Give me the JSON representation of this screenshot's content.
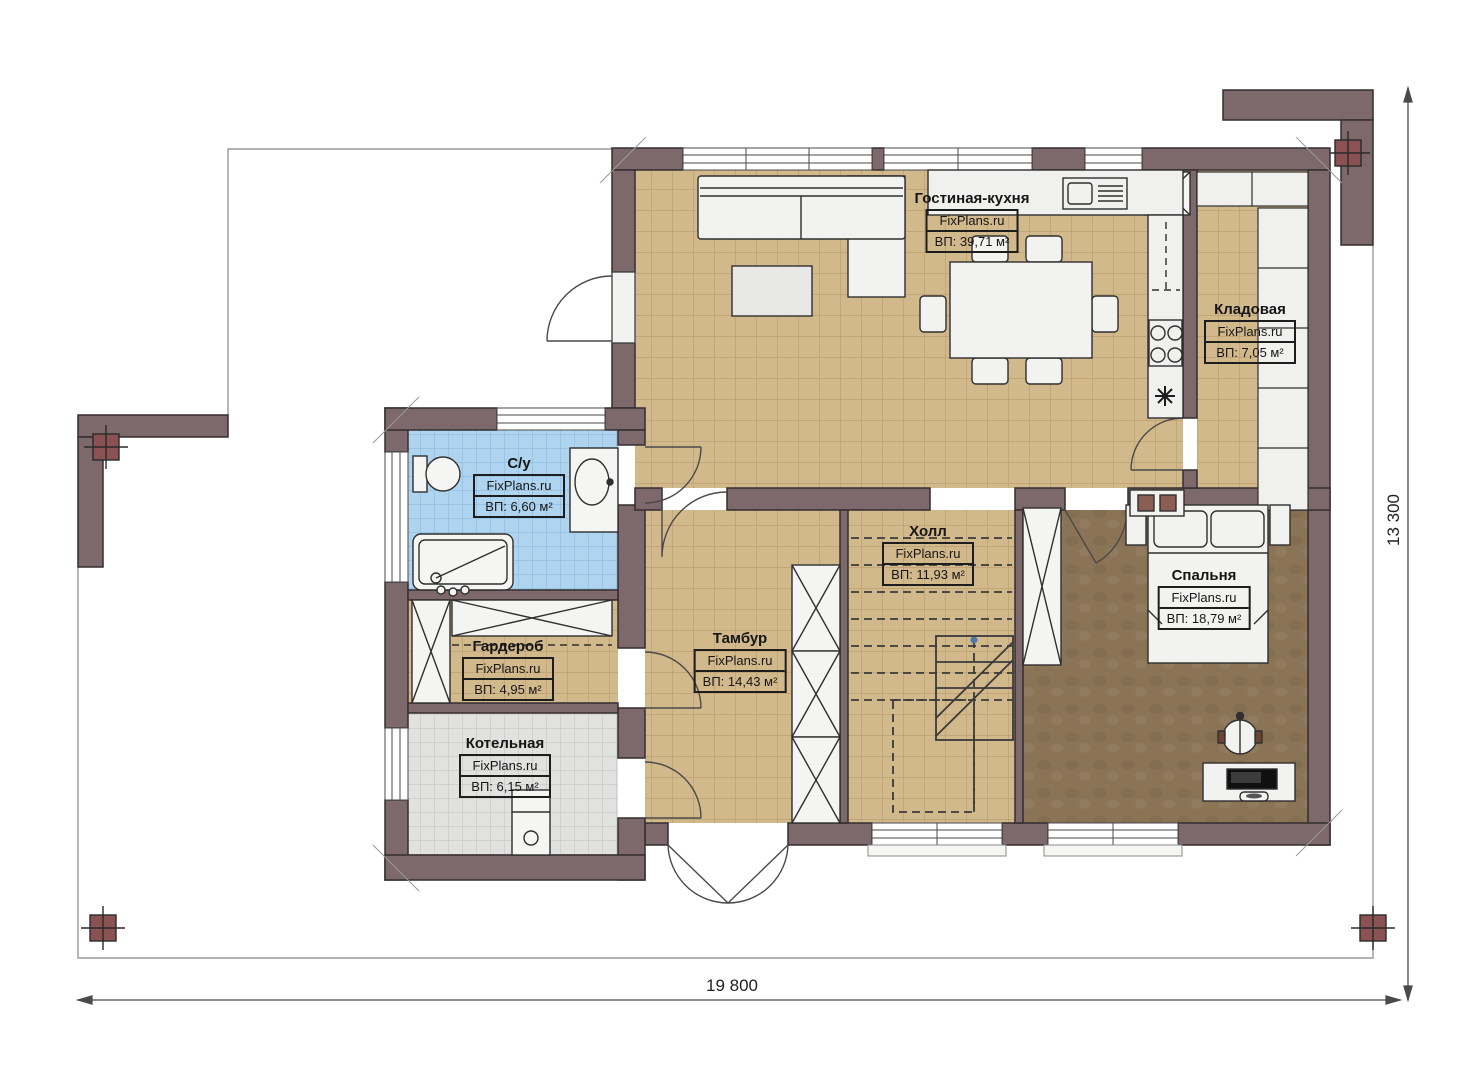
{
  "watermark": "FixPlans.ru",
  "dimensions": {
    "width_mm": "19 800",
    "height_mm": "13 300"
  },
  "rooms": [
    {
      "name": "Гостиная-кухня",
      "watermark": "FixPlans.ru",
      "area": "ВП: 39,71 м²"
    },
    {
      "name": "Кладовая",
      "watermark": "FixPlans.ru",
      "area": "ВП: 7,05 м²"
    },
    {
      "name": "С/у",
      "watermark": "FixPlans.ru",
      "area": "ВП: 6,60 м²"
    },
    {
      "name": "Холл",
      "watermark": "FixPlans.ru",
      "area": "ВП: 11,93 м²"
    },
    {
      "name": "Тамбур",
      "watermark": "FixPlans.ru",
      "area": "ВП: 14,43 м²"
    },
    {
      "name": "Гардероб",
      "watermark": "FixPlans.ru",
      "area": "ВП: 4,95 м²"
    },
    {
      "name": "Котельная",
      "watermark": "FixPlans.ru",
      "area": "ВП: 6,15 м²"
    },
    {
      "name": "Спальня",
      "watermark": "FixPlans.ru",
      "area": "ВП: 18,79 м²"
    }
  ],
  "colors": {
    "wall": "#7d686b",
    "floor_tile": "#d2b98c",
    "bedroom_floor": "#8b7456",
    "bath_tile": "#aed4f0",
    "boiler_tile": "#e1e1df",
    "marker": "#8a5252"
  }
}
